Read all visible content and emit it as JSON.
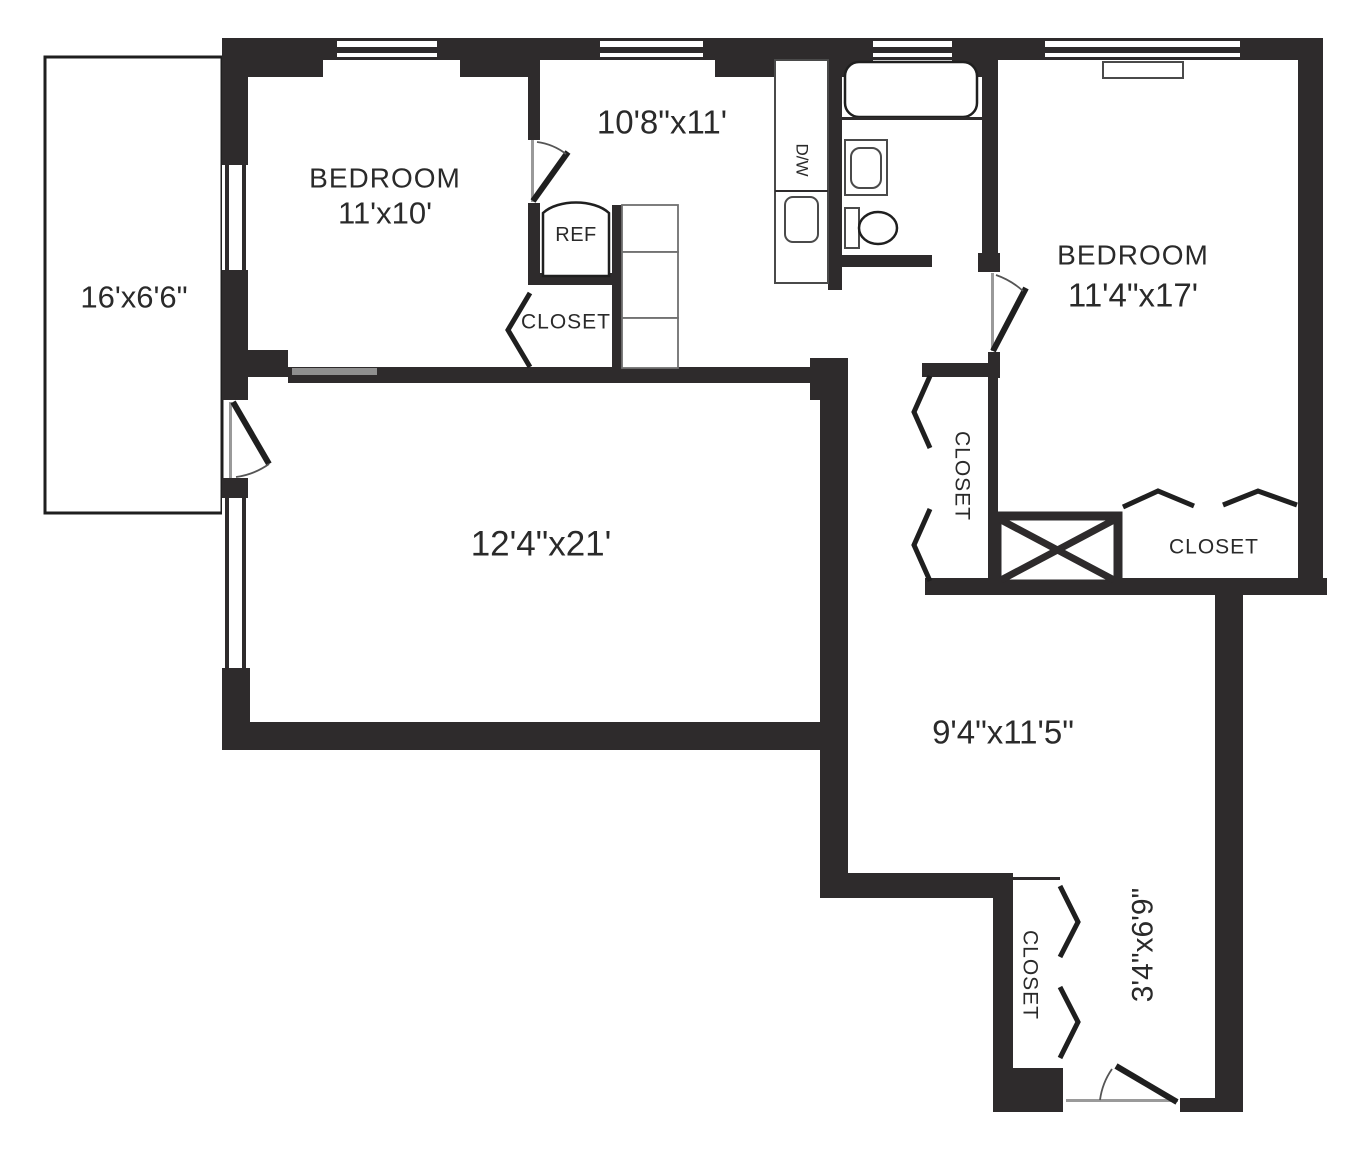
{
  "colors": {
    "wall": "#2e2b2c",
    "line": "#1f1f1f",
    "text": "#2a2a2a",
    "muted": "#8f8f8f",
    "bg": "#ffffff"
  },
  "labels": {
    "balcony_dim": "16'x6'6\"",
    "bedroom1_name": "BEDROOM",
    "bedroom1_dim": "11'x10'",
    "kitchen_dim": "10'8\"x11'",
    "ref": "REF",
    "dw": "D/W",
    "kitchen_closet": "CLOSET",
    "bedroom2_name": "BEDROOM",
    "bedroom2_dim": "11'4\"x17'",
    "living_room_dim": "12'4\"x21'",
    "hall_closet": "CLOSET",
    "bedroom2_closet": "CLOSET",
    "hallway_dim": "9'4\"x11'5\"",
    "entry_closet": "CLOSET",
    "entry_corridor_dim": "3'4\"x6'9\""
  }
}
